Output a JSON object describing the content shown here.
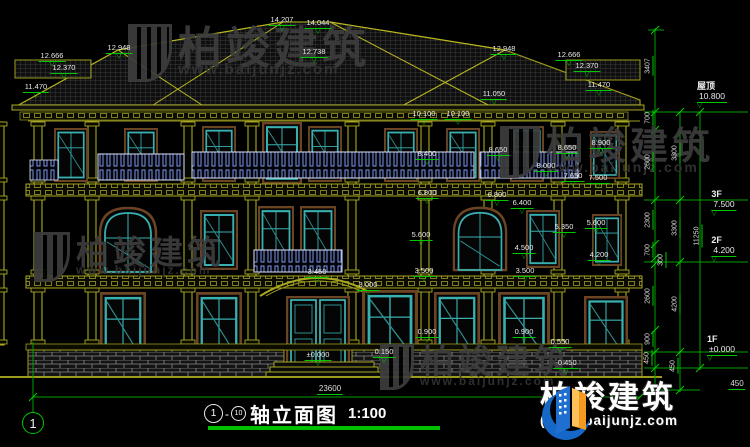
{
  "drawing": {
    "title": {
      "axis_start": "1",
      "separator": "-",
      "axis_end": "10",
      "name": "轴立面图",
      "scale": "1:100"
    },
    "axis_bubble_label": "1",
    "watermark": {
      "brand": "柏竣建筑",
      "url": "www.baijunjz.com"
    },
    "logo": {
      "brand": "柏竣建筑",
      "url": "(www.baijunjz.com"
    },
    "levels": [
      {
        "name": "屋顶",
        "t": "10.800",
        "x": 712,
        "y": 82
      },
      {
        "name": "3F",
        "t": "7.500",
        "x": 724,
        "y": 190
      },
      {
        "name": "2F",
        "t": "4.200",
        "x": 724,
        "y": 236
      },
      {
        "name": "1F",
        "t": "±0.000",
        "x": 722,
        "y": 335
      }
    ],
    "annotations": [
      {
        "t": "12.666",
        "x": 52,
        "y": 52
      },
      {
        "t": "12.370",
        "x": 64,
        "y": 64
      },
      {
        "t": "11.470",
        "x": 36,
        "y": 83
      },
      {
        "t": "12.948",
        "x": 119,
        "y": 44
      },
      {
        "t": "14.207",
        "x": 282,
        "y": 16
      },
      {
        "t": "14.044",
        "x": 318,
        "y": 19
      },
      {
        "t": "12.738",
        "x": 314,
        "y": 48
      },
      {
        "t": "12.948",
        "x": 504,
        "y": 45
      },
      {
        "t": "12.666",
        "x": 569,
        "y": 51
      },
      {
        "t": "12.370",
        "x": 587,
        "y": 62
      },
      {
        "t": "11.470",
        "x": 599,
        "y": 81
      },
      {
        "t": "11.050",
        "x": 494,
        "y": 90
      },
      {
        "t": "10.100",
        "x": 424,
        "y": 110
      },
      {
        "t": "10.100",
        "x": 458,
        "y": 110
      },
      {
        "t": "8.400",
        "x": 427,
        "y": 150
      },
      {
        "t": "8.650",
        "x": 498,
        "y": 146
      },
      {
        "t": "8.650",
        "x": 567,
        "y": 144
      },
      {
        "t": "8.900",
        "x": 601,
        "y": 139
      },
      {
        "t": "8.000",
        "x": 546,
        "y": 162
      },
      {
        "t": "7.650",
        "x": 573,
        "y": 172
      },
      {
        "t": "7.500",
        "x": 598,
        "y": 174
      },
      {
        "t": "6.800",
        "x": 427,
        "y": 189
      },
      {
        "t": "6.800",
        "x": 497,
        "y": 191
      },
      {
        "t": "6.400",
        "x": 522,
        "y": 199
      },
      {
        "t": "5.600",
        "x": 421,
        "y": 231
      },
      {
        "t": "5.600",
        "x": 596,
        "y": 219
      },
      {
        "t": "5.350",
        "x": 564,
        "y": 223
      },
      {
        "t": "4.500",
        "x": 524,
        "y": 244
      },
      {
        "t": "4.200",
        "x": 599,
        "y": 251
      },
      {
        "t": "3.450",
        "x": 317,
        "y": 268
      },
      {
        "t": "3.500",
        "x": 424,
        "y": 267
      },
      {
        "t": "3.500",
        "x": 525,
        "y": 267
      },
      {
        "t": "3.000",
        "x": 368,
        "y": 281
      },
      {
        "t": "0.900",
        "x": 427,
        "y": 328
      },
      {
        "t": "0.900",
        "x": 524,
        "y": 328
      },
      {
        "t": "0.550",
        "x": 560,
        "y": 338
      },
      {
        "t": "0.150",
        "x": 384,
        "y": 348
      },
      {
        "t": "±0.000",
        "x": 318,
        "y": 351
      },
      {
        "t": "-0.450",
        "x": 566,
        "y": 359
      }
    ],
    "vdims": [
      {
        "t": "3407",
        "x": 649,
        "y": 66
      },
      {
        "t": "700",
        "x": 649,
        "y": 118
      },
      {
        "t": "2600",
        "x": 649,
        "y": 162
      },
      {
        "t": "3300",
        "x": 676,
        "y": 153
      },
      {
        "t": "2300",
        "x": 649,
        "y": 220
      },
      {
        "t": "700",
        "x": 649,
        "y": 250
      },
      {
        "t": "300",
        "x": 662,
        "y": 260
      },
      {
        "t": "3300",
        "x": 676,
        "y": 228
      },
      {
        "t": "11250",
        "x": 698,
        "y": 236
      },
      {
        "t": "2600",
        "x": 649,
        "y": 296
      },
      {
        "t": "4200",
        "x": 676,
        "y": 304
      },
      {
        "t": "900",
        "x": 649,
        "y": 339
      },
      {
        "t": "450",
        "x": 648,
        "y": 358
      },
      {
        "t": "450",
        "x": 674,
        "y": 366
      }
    ],
    "hdims": [
      {
        "t": "23600",
        "x": 330,
        "y": 385
      },
      {
        "t": "450",
        "x": 737,
        "y": 380
      }
    ]
  }
}
